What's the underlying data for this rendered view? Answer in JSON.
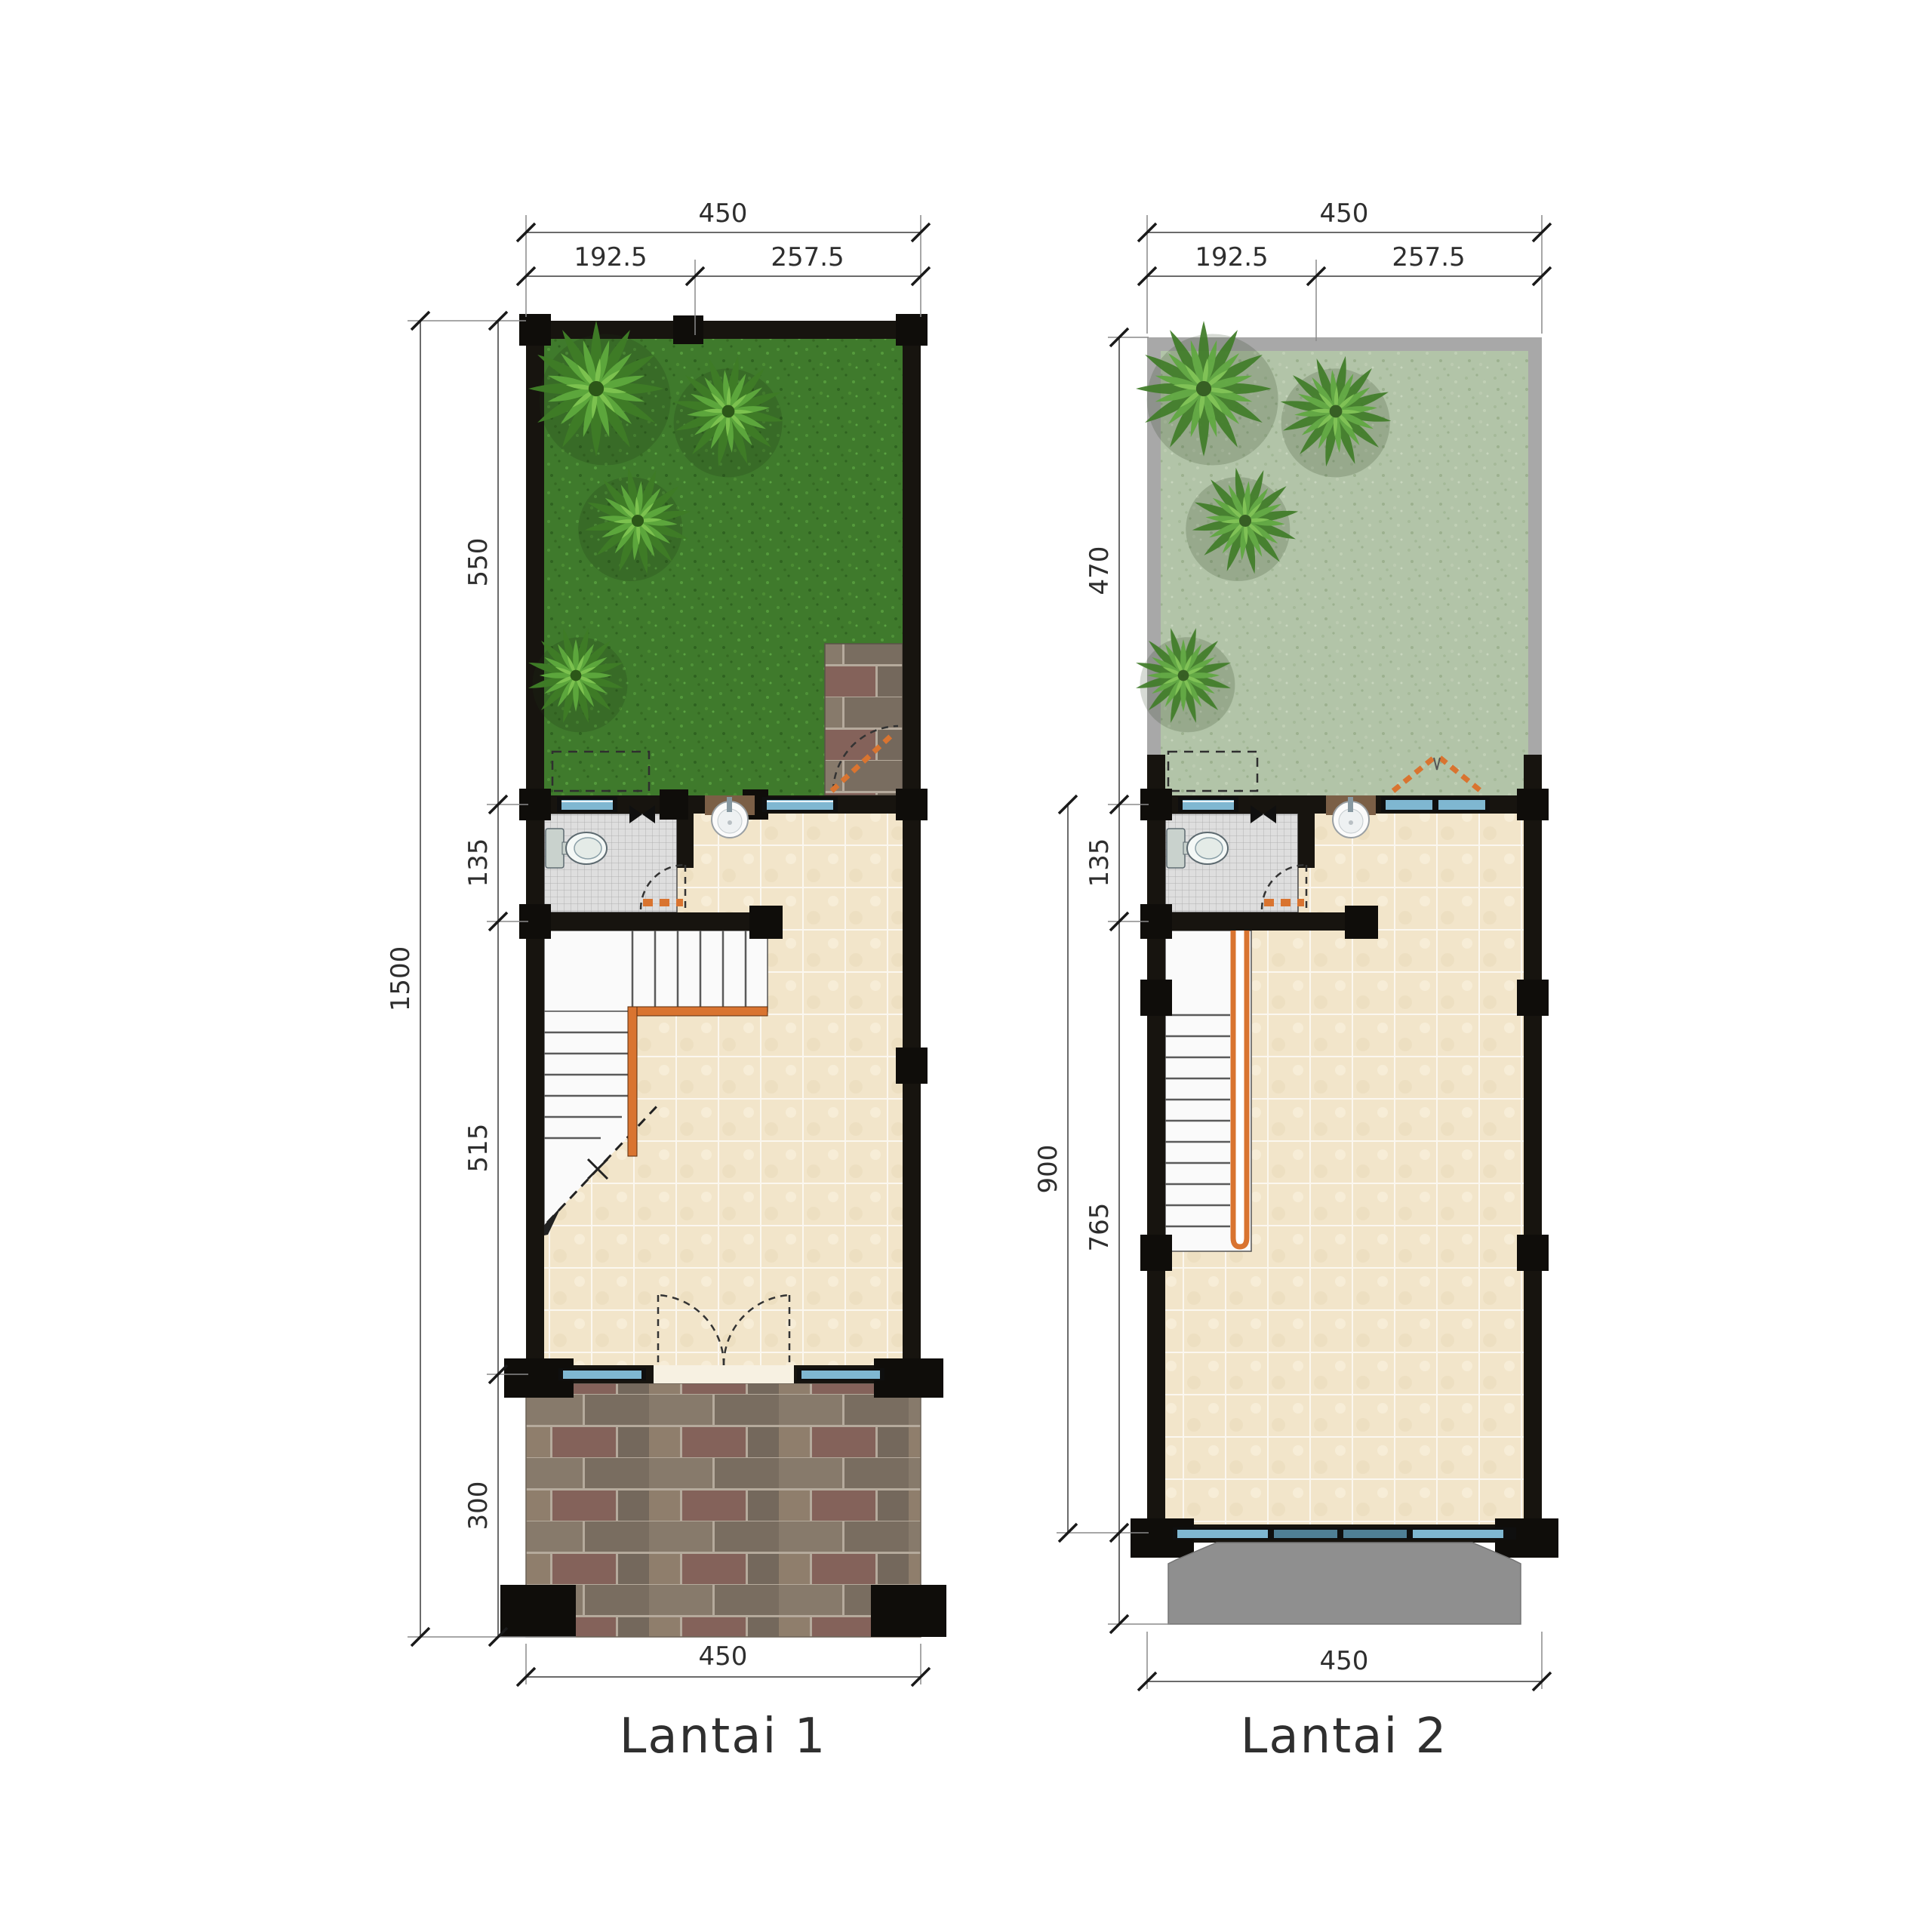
{
  "colors": {
    "accent_orange": "#d97430",
    "wall_black": "#17140f",
    "grass_floor1": "#3f7a2c",
    "grass_floor2": "#b2c4a8",
    "tile_beige": "#f2e5ca",
    "bathroom_gray": "#dedede",
    "window_blue": "#7fb7d1",
    "balcony_gray": "#8f8f8f",
    "roof_edge_gray": "#a8a8a8"
  },
  "plan1": {
    "label": "Lantai 1",
    "dims": {
      "top_total": "450",
      "top_left": "192.5",
      "top_right": "257.5",
      "side_total": "1500",
      "side_seg1": "550",
      "side_seg2": "135",
      "side_seg3": "515",
      "side_seg4": "300",
      "bottom_total": "450"
    }
  },
  "plan2": {
    "label": "Lantai 2",
    "dims": {
      "top_total": "450",
      "top_left": "192.5",
      "top_right": "257.5",
      "side_outer": "900",
      "side_seg1": "470",
      "side_seg2": "135",
      "side_seg3": "765",
      "bottom_total": "450"
    }
  }
}
